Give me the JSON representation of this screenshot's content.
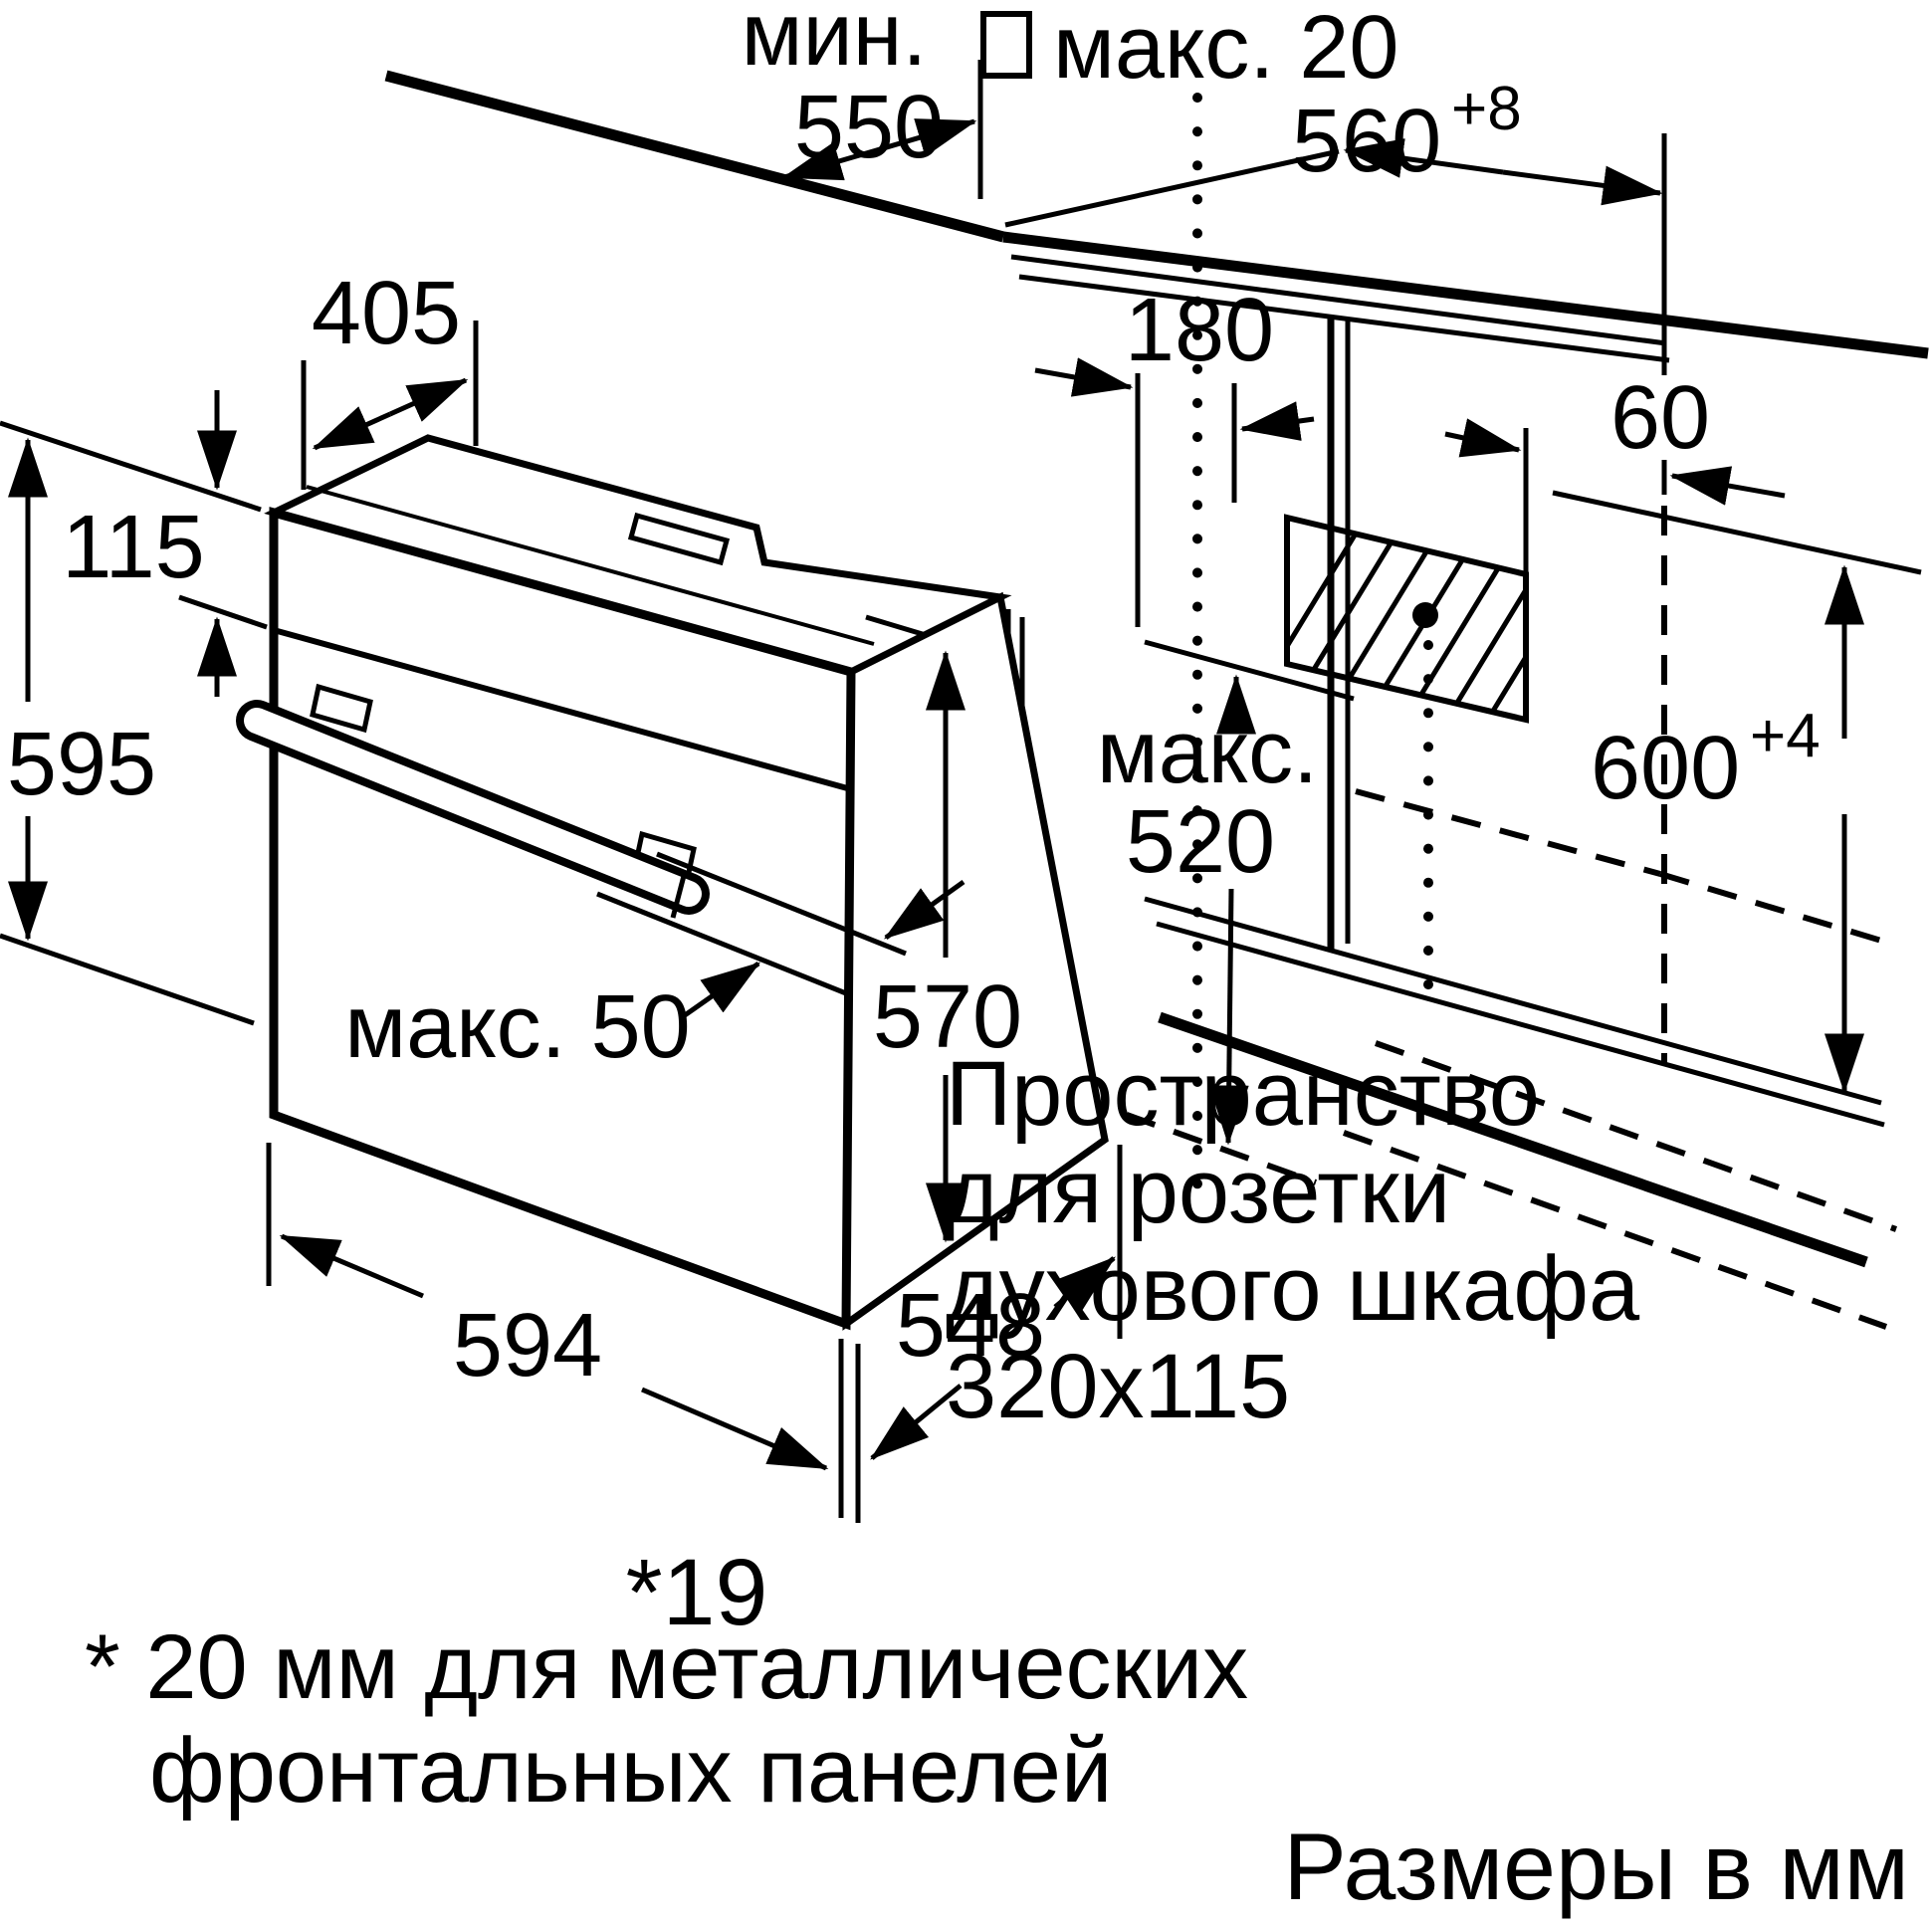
{
  "page": {
    "background": "#ffffff",
    "line_color": "#000000"
  },
  "dimensions": {
    "niche_depth_min_label": "мин.",
    "niche_depth_min_value": "550",
    "counter_gap_max": "макс. 20",
    "niche_width_value": "560",
    "niche_width_tolerance": "+8",
    "oven_top_depth": "405",
    "cutout_offset": "180",
    "socket_offset": "60",
    "panel_height": "115",
    "oven_height": "595",
    "insert_depth_max_label": "макс.",
    "insert_depth_max_value": "520",
    "niche_height_value": "600",
    "niche_height_tolerance": "+4",
    "body_height": "570",
    "handle_clearance_max": "макс. 50",
    "oven_width": "594",
    "body_depth": "548",
    "door_panel_thickness": "*19"
  },
  "annotations": {
    "socket_note_line1": "Пространство",
    "socket_note_line2": "для розетки",
    "socket_note_line3": "духового шкафа",
    "socket_note_line4": "320x115",
    "footnote_line1": "* 20 мм для металлических",
    "footnote_line2": "фронтальных панелей",
    "units_note": "Размеры в мм"
  }
}
